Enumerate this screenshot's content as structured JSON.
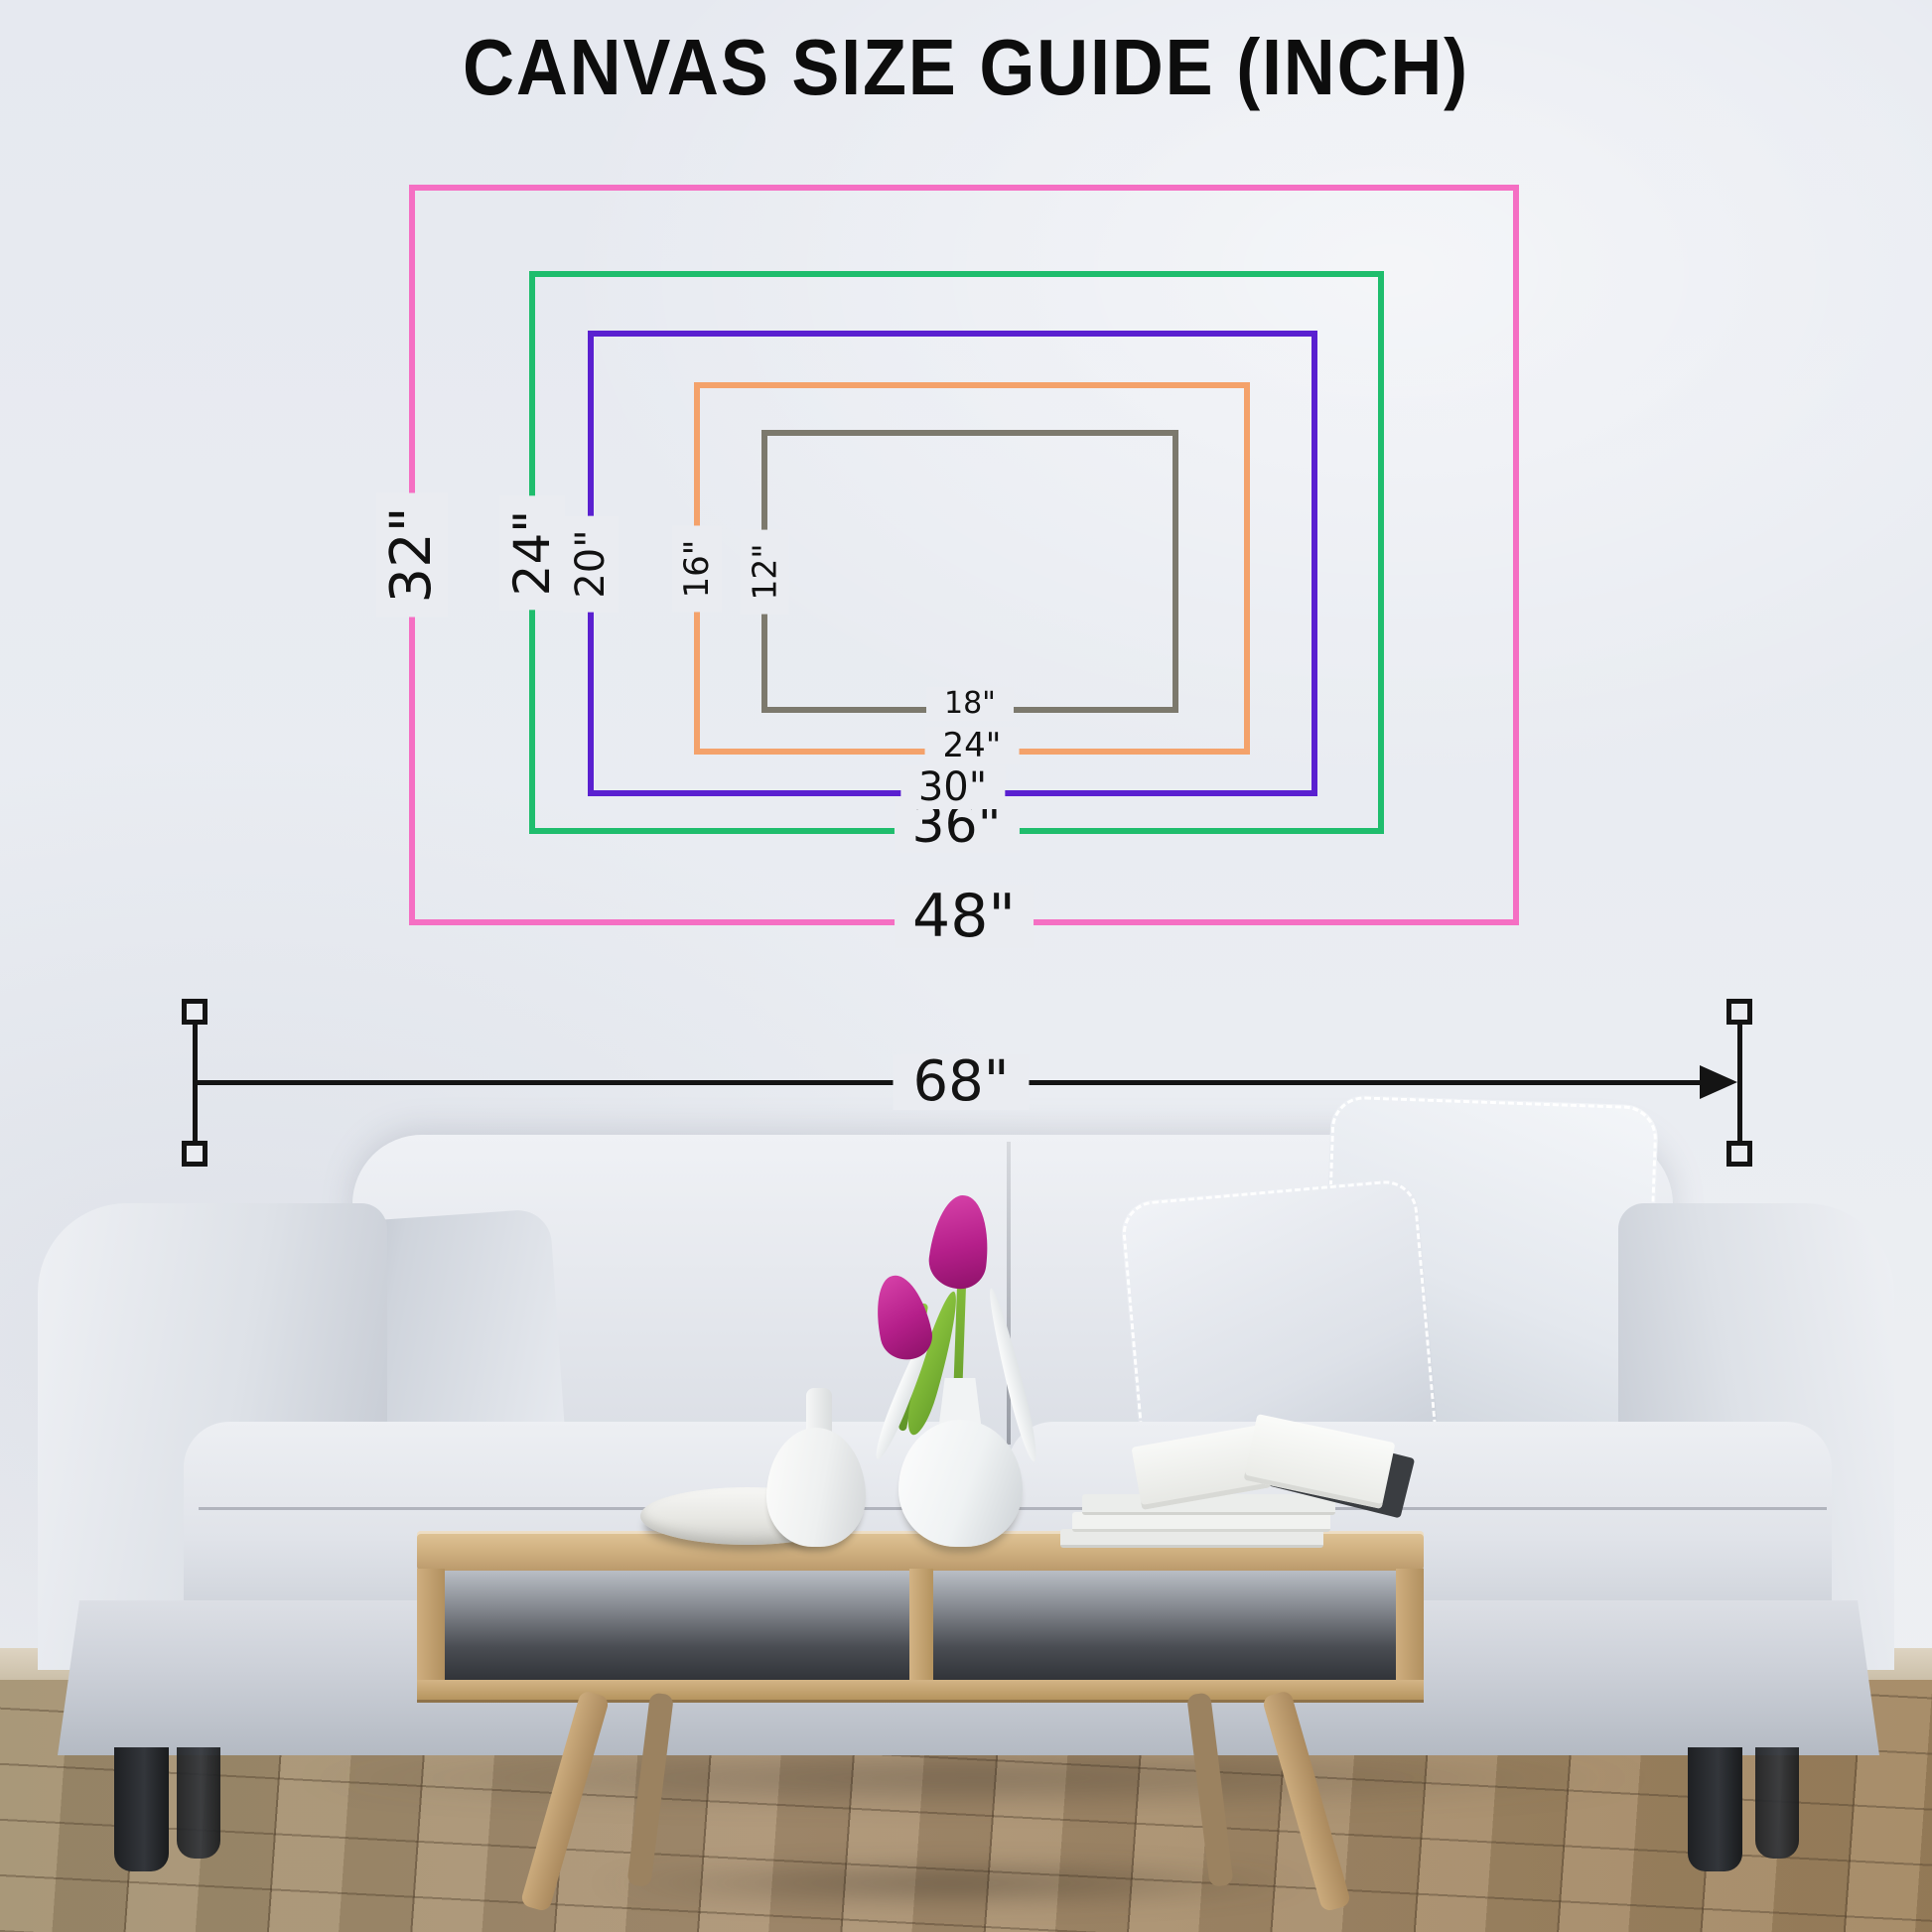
{
  "title": "CANVAS SIZE GUIDE (INCH)",
  "unit": "inch",
  "canvas_sizes": [
    {
      "name": "48x32",
      "width_label": "48\"",
      "height_label": "32\"",
      "width_in": 48,
      "height_in": 32,
      "color": "#f56fc3"
    },
    {
      "name": "36x24",
      "width_label": "36\"",
      "height_label": "24\"",
      "width_in": 36,
      "height_in": 24,
      "color": "#1fbd6d"
    },
    {
      "name": "30x20",
      "width_label": "30\"",
      "height_label": "20\"",
      "width_in": 30,
      "height_in": 20,
      "color": "#5a20d0"
    },
    {
      "name": "24x16",
      "width_label": "24\"",
      "height_label": "16\"",
      "width_in": 24,
      "height_in": 16,
      "color": "#f4a26b"
    },
    {
      "name": "18x12",
      "width_label": "18\"",
      "height_label": "12\"",
      "width_in": 18,
      "height_in": 12,
      "color": "#7c796d"
    }
  ],
  "sofa_measurement": {
    "label": "68\"",
    "value_in": 68
  },
  "scene": {
    "wall_color": "#eaecf1",
    "floor_color": "#a98f6f",
    "description": "light gray sofa with pillows, wooden coffee table with bowl, vases, tulips and books, on a wooden floor"
  }
}
